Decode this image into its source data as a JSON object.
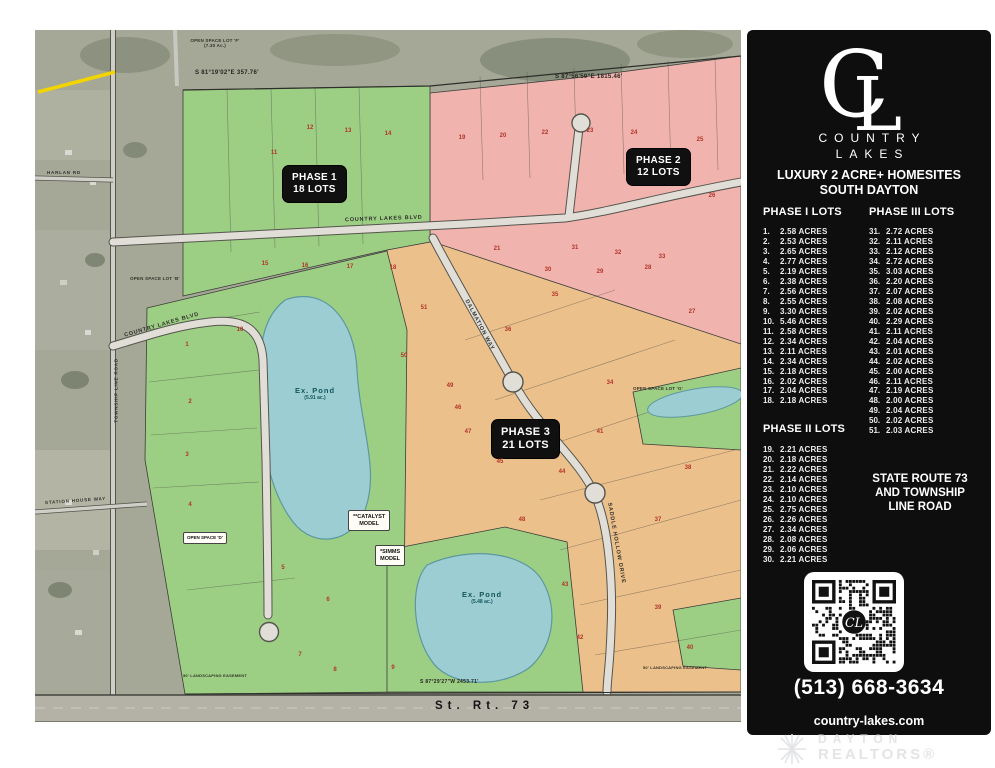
{
  "sidebar": {
    "logo": {
      "monogram_c": "C",
      "monogram_l": "L",
      "name_top": "COUNTRY",
      "name_bottom": "LAKES"
    },
    "tagline_line1": "LUXURY 2 ACRE+ HOMESITES",
    "tagline_line2": "SOUTH DAYTON",
    "phase1": {
      "title": "PHASE I LOTS",
      "lots": [
        {
          "num": "1.",
          "acres": "2.58 ACRES"
        },
        {
          "num": "2.",
          "acres": "2.53 ACRES"
        },
        {
          "num": "3.",
          "acres": "2.65 ACRES"
        },
        {
          "num": "4.",
          "acres": "2.77 ACRES"
        },
        {
          "num": "5.",
          "acres": "2.19 ACRES"
        },
        {
          "num": "6.",
          "acres": "2.38 ACRES"
        },
        {
          "num": "7.",
          "acres": "2.56 ACRES"
        },
        {
          "num": "8.",
          "acres": "2.55 ACRES"
        },
        {
          "num": "9.",
          "acres": "3.30 ACRES"
        },
        {
          "num": "10.",
          "acres": "5.46 ACRES"
        },
        {
          "num": "11.",
          "acres": "2.58 ACRES"
        },
        {
          "num": "12.",
          "acres": "2.34 ACRES"
        },
        {
          "num": "13.",
          "acres": "2.11 ACRES"
        },
        {
          "num": "14.",
          "acres": "2.34 ACRES"
        },
        {
          "num": "15.",
          "acres": "2.18 ACRES"
        },
        {
          "num": "16.",
          "acres": "2.02 ACRES"
        },
        {
          "num": "17.",
          "acres": "2.04 ACRES"
        },
        {
          "num": "18.",
          "acres": "2.18 ACRES"
        }
      ]
    },
    "phase3": {
      "title": "PHASE III LOTS",
      "lots": [
        {
          "num": "31.",
          "acres": "2.72 ACRES"
        },
        {
          "num": "32.",
          "acres": "2.11 ACRES"
        },
        {
          "num": "33.",
          "acres": "2.12 ACRES"
        },
        {
          "num": "34.",
          "acres": "2.72 ACRES"
        },
        {
          "num": "35.",
          "acres": "3.03 ACRES"
        },
        {
          "num": "36.",
          "acres": "2.20 ACRES"
        },
        {
          "num": "37.",
          "acres": "2.07 ACRES"
        },
        {
          "num": "38.",
          "acres": "2.08 ACRES"
        },
        {
          "num": "39.",
          "acres": "2.02 ACRES"
        },
        {
          "num": "40.",
          "acres": "2.29 ACRES"
        },
        {
          "num": "41.",
          "acres": "2.11 ACRES"
        },
        {
          "num": "42.",
          "acres": "2.04 ACRES"
        },
        {
          "num": "43.",
          "acres": "2.01 ACRES"
        },
        {
          "num": "44.",
          "acres": "2.02 ACRES"
        },
        {
          "num": "45.",
          "acres": "2.00 ACRES"
        },
        {
          "num": "46.",
          "acres": "2.11 ACRES"
        },
        {
          "num": "47.",
          "acres": "2.19 ACRES"
        },
        {
          "num": "48.",
          "acres": "2.00 ACRES"
        },
        {
          "num": "49.",
          "acres": "2.04 ACRES"
        },
        {
          "num": "50.",
          "acres": "2.02 ACRES"
        },
        {
          "num": "51.",
          "acres": "2.03 ACRES"
        }
      ]
    },
    "phase2": {
      "title": "PHASE II LOTS",
      "lots": [
        {
          "num": "19.",
          "acres": "2.21 ACRES"
        },
        {
          "num": "20.",
          "acres": "2.18 ACRES"
        },
        {
          "num": "21.",
          "acres": "2.22 ACRES"
        },
        {
          "num": "22.",
          "acres": "2.14 ACRES"
        },
        {
          "num": "23.",
          "acres": "2.10 ACRES"
        },
        {
          "num": "24.",
          "acres": "2.10 ACRES"
        },
        {
          "num": "25.",
          "acres": "2.75 ACRES"
        },
        {
          "num": "26.",
          "acres": "2.26 ACRES"
        },
        {
          "num": "27.",
          "acres": "2.34 ACRES"
        },
        {
          "num": "28.",
          "acres": "2.08 ACRES"
        },
        {
          "num": "29.",
          "acres": "2.06 ACRES"
        },
        {
          "num": "30.",
          "acres": "2.21 ACRES"
        }
      ]
    },
    "location": {
      "line1": "STATE ROUTE 73",
      "line2": "AND TOWNSHIP",
      "line3": "LINE ROAD"
    },
    "phone": "(513) 668-3634",
    "website": "country-lakes.com"
  },
  "footer": {
    "realtor_line1": "DAYTON",
    "realtor_line2": "REALTORS®"
  },
  "map": {
    "phase1_label": {
      "line1": "PHASE 1",
      "line2": "18 LOTS"
    },
    "phase2_label": {
      "line1": "PHASE 2",
      "line2": "12 LOTS"
    },
    "phase3_label": {
      "line1": "PHASE 3",
      "line2": "21 LOTS"
    },
    "pond1": {
      "line1": "Ex. Pond",
      "line2": "(5.91 ac.)"
    },
    "pond2": {
      "line1": "Ex. Pond",
      "line2": "(5.48 ac.)"
    },
    "catalyst_model": {
      "line1": "**CATALYST",
      "line2": "MODEL"
    },
    "simms_model": {
      "line1": "*SIMMS",
      "line2": "MODEL"
    },
    "roads": {
      "country_lakes_blvd": "COUNTRY LAKES BLVD",
      "country_lakes_blvd_left": "COUNTRY LAKES BLVD",
      "dalmation": "DALMATION WAY",
      "hollow": "SADDLE HOLLOW DRIVE",
      "township": "TOWNSHIP LINE ROAD",
      "harlan": "HARLAN RD",
      "station_house": "STATION HOUSE WAY",
      "state_route": "St.  Rt.  73"
    },
    "bearings": {
      "top_left": "S 81°19'02\"E  357.76'",
      "top_right": "S 87°56'59\"E  1815.46'",
      "bottom": "S 87°29'27\"W  2453.71'"
    },
    "open_space": {
      "f1": "OPEN SPACE LOT 'F'",
      "f2": "(7.30 Ac.)",
      "b": "OPEN SPACE LOT 'B'",
      "d": "OPEN SPACE 'D'",
      "g": "OPEN SPACE LOT 'G'"
    },
    "easement_left": "50' LANDSCAPING EASEMENT",
    "easement_right": "50' LANDSCAPING EASEMENT",
    "lot_markers": [
      {
        "n": "1",
        "x": 152,
        "y": 315
      },
      {
        "n": "2",
        "x": 155,
        "y": 372
      },
      {
        "n": "3",
        "x": 152,
        "y": 425
      },
      {
        "n": "4",
        "x": 155,
        "y": 475
      },
      {
        "n": "5",
        "x": 248,
        "y": 538
      },
      {
        "n": "6",
        "x": 293,
        "y": 570
      },
      {
        "n": "7",
        "x": 265,
        "y": 625
      },
      {
        "n": "8",
        "x": 300,
        "y": 640
      },
      {
        "n": "9",
        "x": 358,
        "y": 638
      },
      {
        "n": "10",
        "x": 205,
        "y": 300
      },
      {
        "n": "11",
        "x": 239,
        "y": 123
      },
      {
        "n": "12",
        "x": 275,
        "y": 98
      },
      {
        "n": "13",
        "x": 313,
        "y": 101
      },
      {
        "n": "14",
        "x": 353,
        "y": 104
      },
      {
        "n": "15",
        "x": 230,
        "y": 234
      },
      {
        "n": "16",
        "x": 270,
        "y": 236
      },
      {
        "n": "17",
        "x": 315,
        "y": 237
      },
      {
        "n": "18",
        "x": 358,
        "y": 238
      },
      {
        "n": "19",
        "x": 427,
        "y": 108
      },
      {
        "n": "20",
        "x": 468,
        "y": 106
      },
      {
        "n": "21",
        "x": 462,
        "y": 219
      },
      {
        "n": "22",
        "x": 510,
        "y": 103
      },
      {
        "n": "23",
        "x": 555,
        "y": 101
      },
      {
        "n": "24",
        "x": 599,
        "y": 103
      },
      {
        "n": "25",
        "x": 665,
        "y": 110
      },
      {
        "n": "26",
        "x": 677,
        "y": 166
      },
      {
        "n": "27",
        "x": 657,
        "y": 282
      },
      {
        "n": "28",
        "x": 613,
        "y": 238
      },
      {
        "n": "29",
        "x": 565,
        "y": 242
      },
      {
        "n": "30",
        "x": 513,
        "y": 240
      },
      {
        "n": "31",
        "x": 540,
        "y": 218
      },
      {
        "n": "32",
        "x": 583,
        "y": 223
      },
      {
        "n": "33",
        "x": 627,
        "y": 227
      },
      {
        "n": "34",
        "x": 575,
        "y": 353
      },
      {
        "n": "35",
        "x": 520,
        "y": 265
      },
      {
        "n": "36",
        "x": 473,
        "y": 300
      },
      {
        "n": "37",
        "x": 623,
        "y": 490
      },
      {
        "n": "38",
        "x": 653,
        "y": 438
      },
      {
        "n": "39",
        "x": 623,
        "y": 578
      },
      {
        "n": "40",
        "x": 655,
        "y": 618
      },
      {
        "n": "41",
        "x": 565,
        "y": 402
      },
      {
        "n": "42",
        "x": 545,
        "y": 608
      },
      {
        "n": "43",
        "x": 530,
        "y": 555
      },
      {
        "n": "44",
        "x": 527,
        "y": 442
      },
      {
        "n": "45",
        "x": 465,
        "y": 432
      },
      {
        "n": "46",
        "x": 423,
        "y": 378
      },
      {
        "n": "47",
        "x": 433,
        "y": 402
      },
      {
        "n": "48",
        "x": 487,
        "y": 490
      },
      {
        "n": "49",
        "x": 415,
        "y": 356
      },
      {
        "n": "50",
        "x": 369,
        "y": 326
      },
      {
        "n": "51",
        "x": 389,
        "y": 278
      }
    ]
  },
  "colors": {
    "phase1_green": "#9ccf84",
    "phase2_pink": "#f0b3ae",
    "phase3_orange": "#ecc08b",
    "pond_teal": "#9ccdd2",
    "road_gray": "#e0ded6",
    "sidebar_black": "#0e0e0e",
    "lot_number_red": "#b3342a"
  }
}
